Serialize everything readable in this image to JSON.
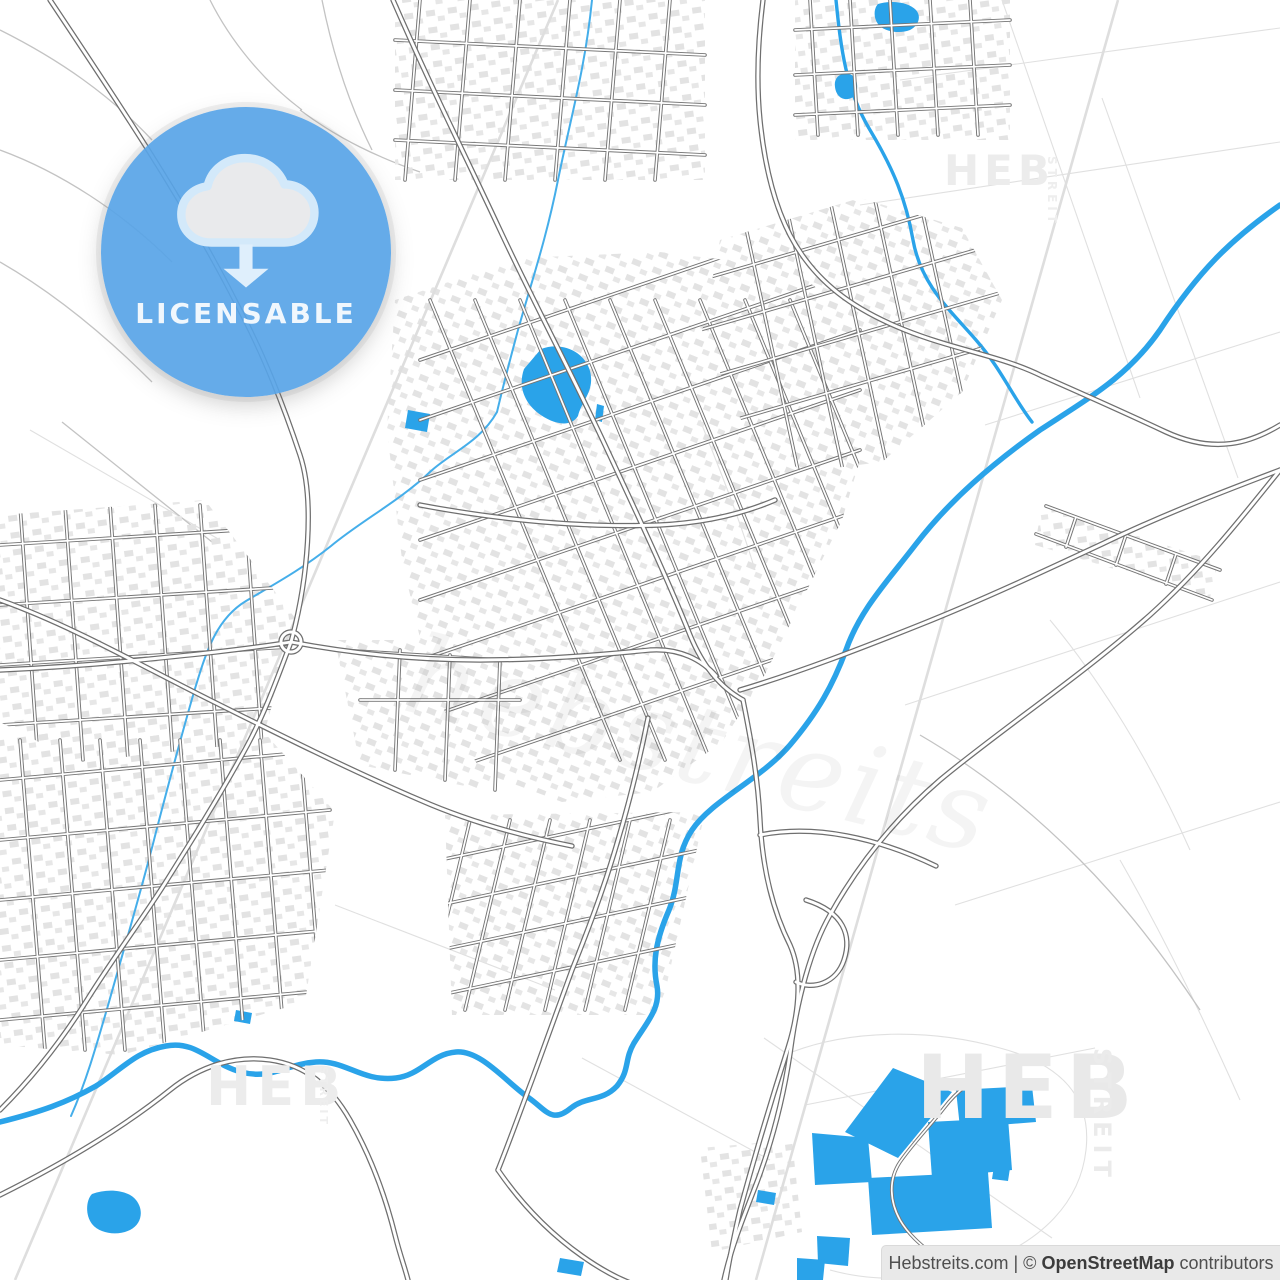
{
  "badge": {
    "label": "LICENSABLE",
    "icon": "cloud-download-icon",
    "bg_color": "#58a5e8",
    "icon_fill": "#e9eaec",
    "icon_outline": "#d3e9fa",
    "text_color": "#f0f7fd"
  },
  "watermarks": {
    "brand": "HEB",
    "sub": "STREIT",
    "script": "hebstreits"
  },
  "attribution": {
    "source": "Hebstreits.com",
    "divider": "| ©",
    "provider": "OpenStreetMap",
    "suffix": "contributors",
    "bg_color": "#e9e9e9",
    "text_color": "#4f4f4f"
  },
  "map": {
    "type": "city-street-map",
    "style": "light OpenStreetMap vector style",
    "colors": {
      "background": "#ffffff",
      "water": "#2aa3e9",
      "stream": "#45aeea",
      "road_casing": "#6f6f6f",
      "road_fill": "#ffffff",
      "minor_road": "#8a8a8a",
      "rural_path": "#c3c3c3",
      "field_line": "#e0e0e0",
      "railway": "#dedede",
      "building": "#e3e3e3"
    },
    "features": [
      "river",
      "canal",
      "lake",
      "fish-ponds",
      "town-street-grid",
      "suburb-street-grid",
      "highway-interchange",
      "railway-line",
      "residential-buildings",
      "roundabout",
      "rural-paths",
      "field-boundaries"
    ]
  }
}
